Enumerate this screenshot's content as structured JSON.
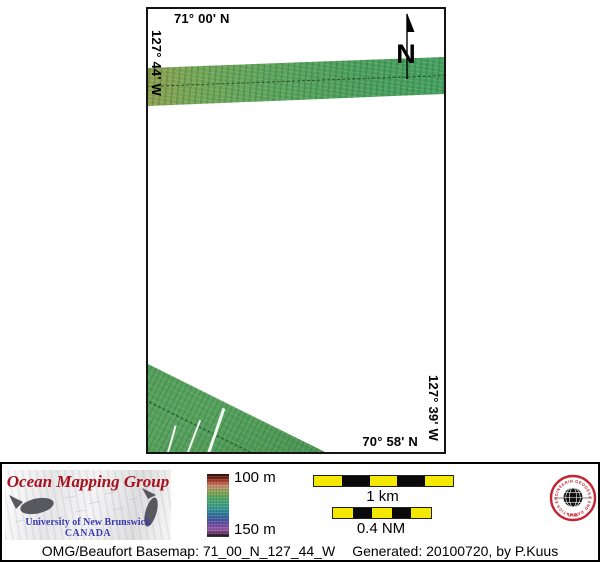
{
  "map": {
    "labels": {
      "top": "71° 00' N",
      "left": "127° 44' W",
      "right": "127° 39' W",
      "bottom": "70° 58' N"
    },
    "north_arrow": "N",
    "colors": {
      "swath_green": "#55a35c",
      "swath_olive": "#90a050",
      "frame_border": "#141414"
    }
  },
  "legend": {
    "omg_logo": {
      "title": "Ocean Mapping Group",
      "institution": "University of New Brunswick",
      "country": "CANADA",
      "title_color": "#a8101c",
      "text_color": "#3b3bb0"
    },
    "colorbar": {
      "top_label": "100 m",
      "bottom_label": "150 m",
      "top_value_m": 100,
      "bottom_value_m": 150,
      "gradient": [
        "#2a0f0b",
        "#7c2418",
        "#b44b38",
        "#c98a74",
        "#8fa055",
        "#55a35c",
        "#3fa07d",
        "#36968f",
        "#2f7499",
        "#41589e",
        "#6b4aa0",
        "#975aa6",
        "#5e3465",
        "#150a14"
      ]
    },
    "scalebars": [
      {
        "label": "1 km",
        "segments": 5
      },
      {
        "label": "0.4 NM",
        "segments": 5
      }
    ],
    "bar_yellow": "#f4e800",
    "seal": {
      "ring_text": "GEODESY AND GEOMATICS ENGINEERING",
      "bottom_text": "UNB",
      "ring_color": "#c42430"
    }
  },
  "footer": {
    "caption": "OMG/Beaufort Basemap: 71_00_N_127_44_W",
    "generated": "Generated: 20100720, by P.Kuus"
  }
}
